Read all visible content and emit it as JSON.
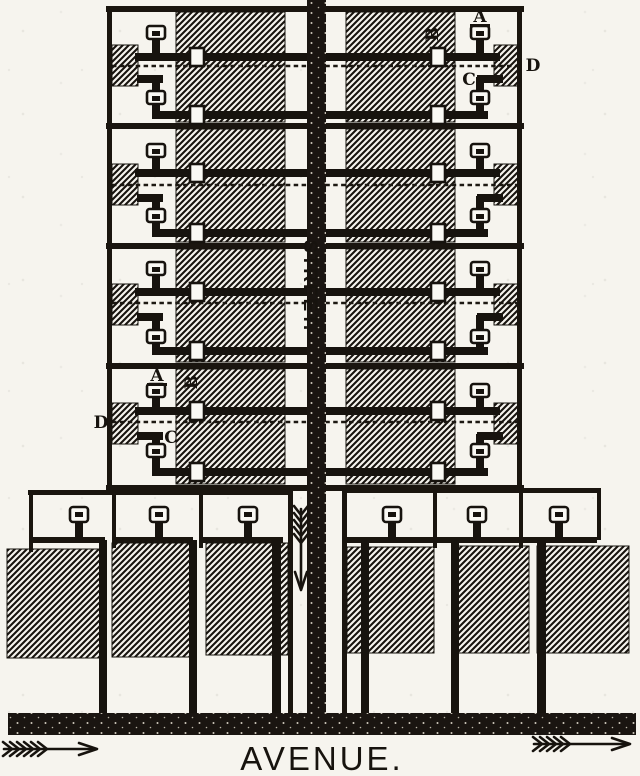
{
  "figure": {
    "street_label": "STREET.",
    "avenue_label": "AVENUE.",
    "callouts": {
      "a": "A",
      "b": "B",
      "c": "C",
      "d": "D"
    },
    "colors": {
      "ink": "#17130e",
      "paper": "#f6f4ee"
    },
    "icons": [
      "flow-arrow-down-icon",
      "flow-arrow-right-icon",
      "flow-arrow-right-icon"
    ]
  }
}
